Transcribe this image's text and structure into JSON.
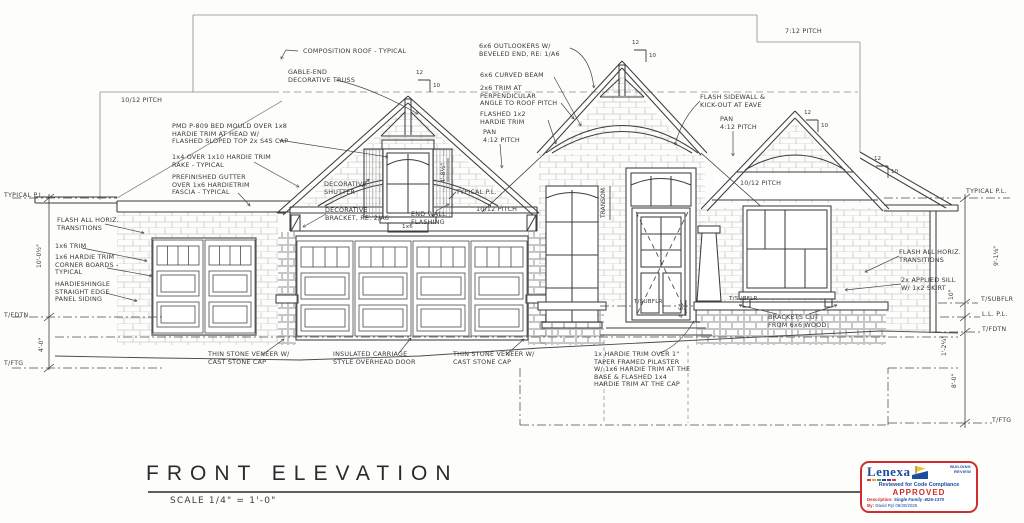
{
  "drawing": {
    "title": "FRONT ELEVATION",
    "scale_note": "SCALE 1/4\" = 1'-0\""
  },
  "annotations": {
    "composition_roof": "COMPOSITION ROOF - TYPICAL",
    "gable_truss": "GABLE-END\nDECORATIVE TRUSS",
    "outlookers": "6x6 OUTLOOKERS W/\nBEVELED END, RE: 1/A6",
    "curved_beam": "6x6 CURVED BEAM",
    "trim_2x6": "2x6 TRIM AT\nPERPENDICULAR\nANGLE TO ROOF PITCH",
    "flashed_trim": "FLASHED 1x2\nHARDIE TRIM",
    "pan_center": "PAN\n4:12 PITCH",
    "pan_right": "PAN\n4:12 PITCH",
    "pitch_7_12": "7:12 PITCH",
    "flash_sidewall": "FLASH SIDEWALL &\nKICK-OUT AT EAVE",
    "pitch_left": "10/12 PITCH",
    "pitch_mid": "10/12 PITCH",
    "pitch_right": "10/12 PITCH",
    "bed_mould": "PMD P-809 BED MOULD OVER 1x8\nHARDIE TRIM AT HEAD W/\nFLASHED SLOPED TOP 2x S4S CAP",
    "rake_trim": "1x4 OVER 1x10 HARDIE TRIM\nRAKE - TYPICAL",
    "gutter": "PREFINISHED GUTTER\nOVER 1x6 HARDIETRIM\nFASCIA - TYPICAL",
    "decorative_shutter": "DECORATIVE\nSHUTTER",
    "decorative_bracket": "DECORATIVE\nBRACKET, RE: 2/A6",
    "end_wall_flashing": "END WALL\nFLASHING",
    "typical_pl_mid": "TYPICAL P.L.",
    "flash_horiz_left": "FLASH ALL HORIZ.\nTRANSITIONS",
    "trim_1x6": "1x6 TRIM",
    "corner_boards": "1x6 HARDIE TRIM\nCORNER BOARDS -\nTYPICAL",
    "hardieshingle": "HARDIESHINGLE\nSTRAIGHT EDGE\nPANEL SIDING",
    "stone_left": "THIN STONE VENEER W/\nCAST STONE CAP",
    "carriage_door": "INSULATED CARRIAGE\nSTYLE OVERHEAD DOOR",
    "stone_right": "THIN STONE VENEER W/\nCAST STONE CAP",
    "taper_pilaster": "1x HARDIE TRIM OVER 1\"\nTAPER FRAMED PILASTER\nW/ 1x6 HARDIE TRIM AT THE\nBASE & FLASHED 1x4\nHARDIE TRIM AT THE CAP",
    "flash_horiz_right": "FLASH ALL HORIZ.\nTRANSITIONS",
    "applied_sill": "2x APPLIED SILL\nW/ 1x2 SKIRT",
    "brackets": "BRACKETS CUT\nFROM 6x6 WOOD",
    "window_trim_1x6": "1x6",
    "tsubflr_door": "T/SUBFLR",
    "tsubflr_porch": "T/SUBFLR",
    "transom": "TRANSOM"
  },
  "edge_labels": {
    "left": {
      "typical_pl": "TYPICAL P.L.",
      "tfdtn": "T/FDTN",
      "tftg": "T/FTG"
    },
    "right": {
      "typical_pl": "TYPICAL P.L.",
      "tsubflr": "T/SUBFLR",
      "ll_pl": "L.L. P.L.",
      "tfdtn": "T/FDTN",
      "tftg": "T/FTG"
    }
  },
  "dimensions": {
    "left_wall": "10'-0½\"",
    "left_ftg": "4'-0\"",
    "gable_window": "4'-8½\"",
    "porch": "4'-6\"",
    "right_wall": "9'-1⅛\"",
    "right_step": "10\"",
    "right_fdtn": "1'-2¼\"",
    "right_ftg": "8'-0\""
  },
  "pitch_marks": {
    "run": "12",
    "rise": "10"
  },
  "stamp": {
    "brand": "Lenexa",
    "dept": "BUILDING\nREVIEW",
    "reviewed": "Reviewed for Code Compliance",
    "status": "APPROVED",
    "description_label": "Description:",
    "description_value": "Single Family -B25-1370",
    "by_label": "By:",
    "by_value": "David Ryl  09/30/2025"
  },
  "colors": {
    "ink": "#3d3d3d",
    "texture": "#b5b5b5",
    "stamp_red": "#cf2e2e",
    "stamp_blue": "#1c4da1",
    "stamp_gold": "#f2c230"
  }
}
